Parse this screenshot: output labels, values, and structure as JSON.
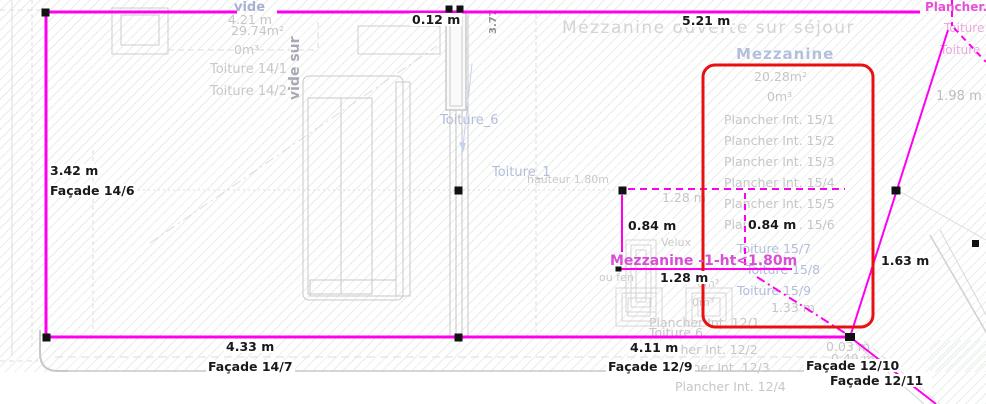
{
  "colors": {
    "wall": "#ff00ee",
    "selection": "#e81111",
    "dimension_text": "#191919",
    "muted_text": "#c6c6c6",
    "room_title": "#b6bede",
    "magenta_label": "#d94fd4"
  },
  "texts": {
    "header": "Mézzanine ouverte sur séjour",
    "room_vide": {
      "label": "vide",
      "dim": "4.21 m",
      "area": "29.74m²",
      "volume": "0m³",
      "roof1": "Toiture 14/1",
      "roof2": "Toiture 14/2",
      "vertical": "vide sur"
    },
    "mezzanine": {
      "label": "Mezzanine",
      "area": "20.28m²",
      "volume": "0m³",
      "floors": [
        "Plancher Int. 15/1",
        "Plancher Int. 15/2",
        "Plancher Int. 15/3",
        "Plancher Int. 15/4",
        "Plancher Int. 15/5",
        "Plancher Int. 15/6"
      ],
      "roofs": [
        "Toiture 15/7",
        "Toiture 15/8",
        "Toiture 15/9"
      ],
      "dim": "1.33 m"
    },
    "dims": {
      "wall_thickness": "0.12 m",
      "top": "5.21 m",
      "left": "3.42 m",
      "velux_height": "0.84 m",
      "velux_height2": "0.84 m",
      "velux_width": "1.28 m",
      "velux_width_ref": "1.28 m",
      "diagonal": "1.63 m",
      "bottom_left": "4.33 m",
      "bottom_right": "4.11 m",
      "right": "1.98 m",
      "offset1": "0.03 m",
      "offset2": "0.49 m",
      "rotated": "3.77",
      "height_note": "hauteur 1.80m"
    },
    "facades": {
      "f14_6": "Façade 14/6",
      "f14_7": "Façade 14/7",
      "f12_9": "Façade 12/9",
      "f12_10": "Façade 12/10",
      "f12_11": "Façade 12/11"
    },
    "annotations": {
      "mezz_height": "Mezzanine -1-ht<1.80m",
      "ou_fen": "ou fen",
      "velux": "Velux",
      "toiture_1": "Toiture_1",
      "toiture_6": "Toiture_6",
      "toiture_6b": "Toiture 6",
      "vol_a": "0m³",
      "vol_b": "0m³",
      "floors12": [
        "Plancher Int. 12/1",
        "Plancher Int. 12/2",
        "Plancher Int. 12/3",
        "Plancher Int. 12/4"
      ],
      "plancher_corner": "Plancher.",
      "toiture_corner1": "Toiture",
      "toiture_corner2": "Toiture"
    }
  }
}
